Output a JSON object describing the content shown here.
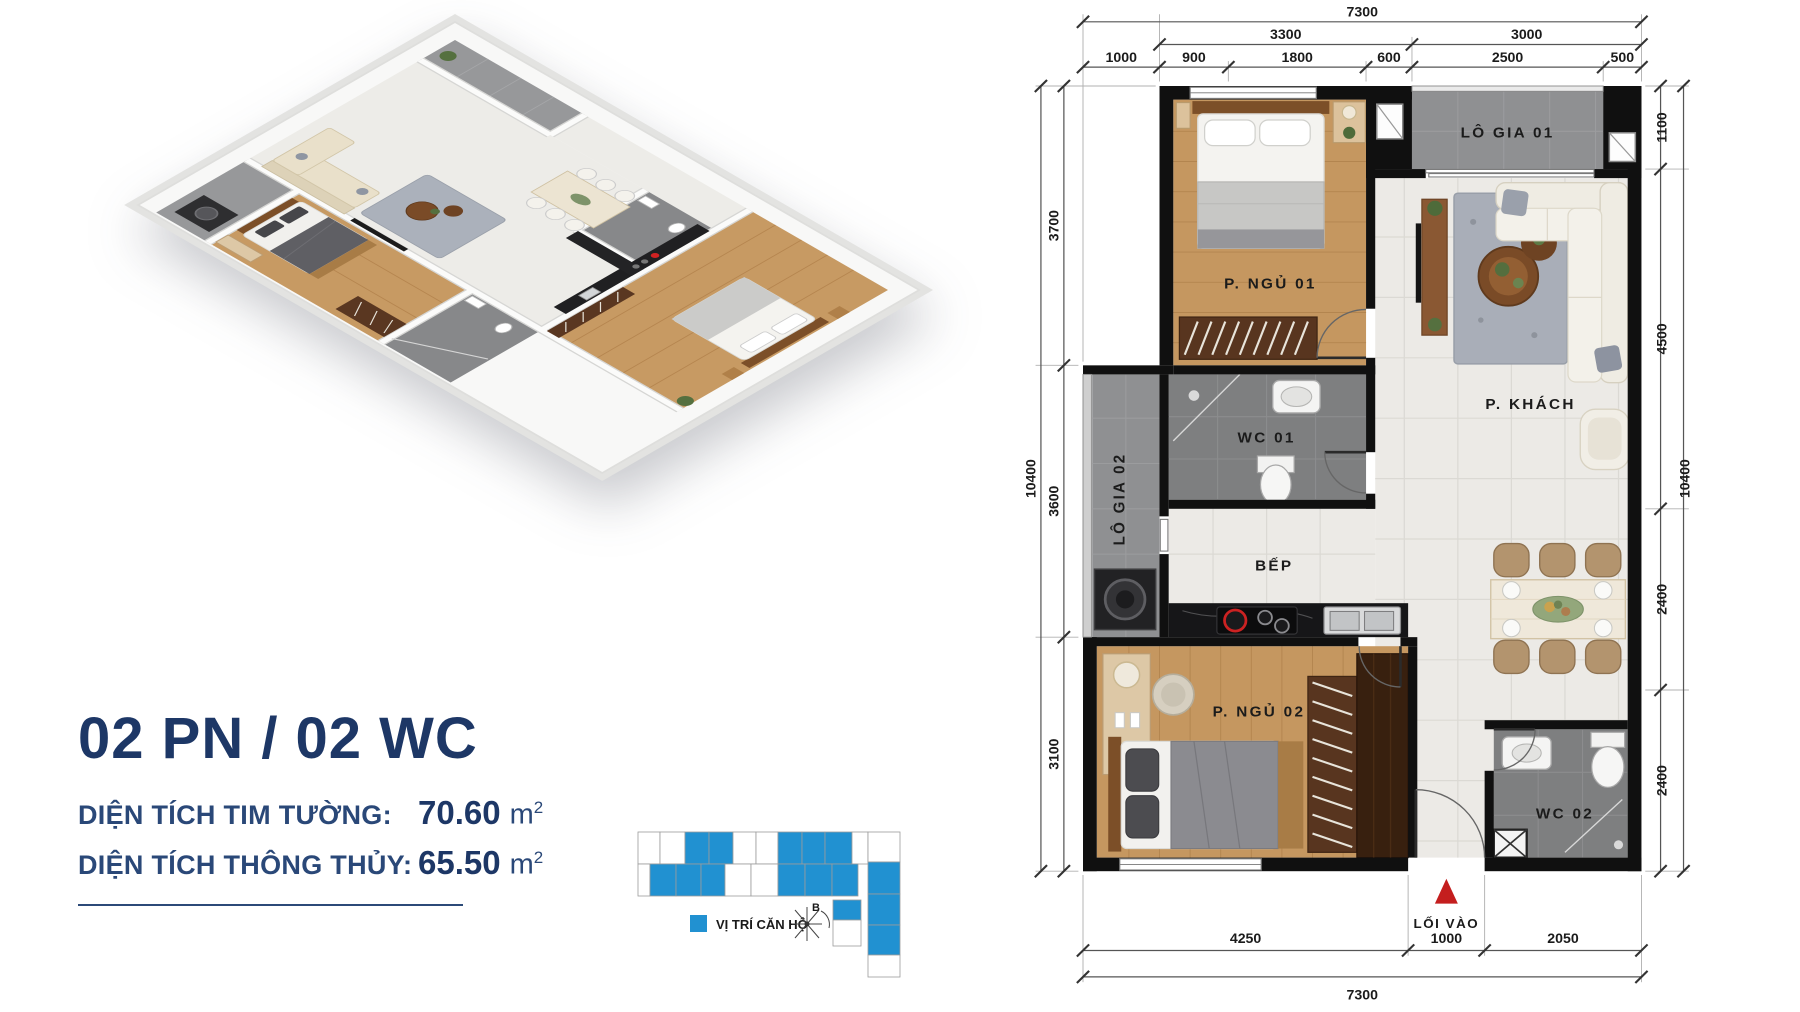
{
  "summary": {
    "title": "02 PN / 02 WC",
    "areas": [
      {
        "label": "DIỆN TÍCH TIM TƯỜNG:",
        "value": "70.60",
        "unit": "m",
        "sup": "2"
      },
      {
        "label": "DIỆN TÍCH THÔNG THỦY:",
        "value": "65.50",
        "unit": "m",
        "sup": "2"
      }
    ]
  },
  "locator": {
    "legend_label": "VỊ TRÍ CĂN HỘ",
    "compass_label": "B",
    "highlight_color": "#2191d1"
  },
  "floorplan": {
    "rooms": {
      "bedroom1": "P. NGỦ 01",
      "wc1": "WC 01",
      "loggia1": "LÔ GIA 01",
      "loggia2": "LÔ GIA 02",
      "kitchen": "BẾP",
      "living": "P. KHÁCH",
      "bedroom2": "P. NGỦ 02",
      "wc2": "WC 02",
      "entrance": "LỐI VÀO"
    },
    "dimensions": {
      "top_total": "7300",
      "top_groups": [
        "3300",
        "3000"
      ],
      "top_segments": [
        "1000",
        "900",
        "1800",
        "600",
        "2500",
        "500"
      ],
      "left_total": "10400",
      "left_segments": [
        "3700",
        "3600",
        "3100"
      ],
      "right_total": "10400",
      "right_segments": [
        "1100",
        "4500",
        "2400",
        "2400"
      ],
      "bottom_total": "7300",
      "bottom_segments": [
        "4250",
        "1000",
        "2050"
      ]
    }
  }
}
